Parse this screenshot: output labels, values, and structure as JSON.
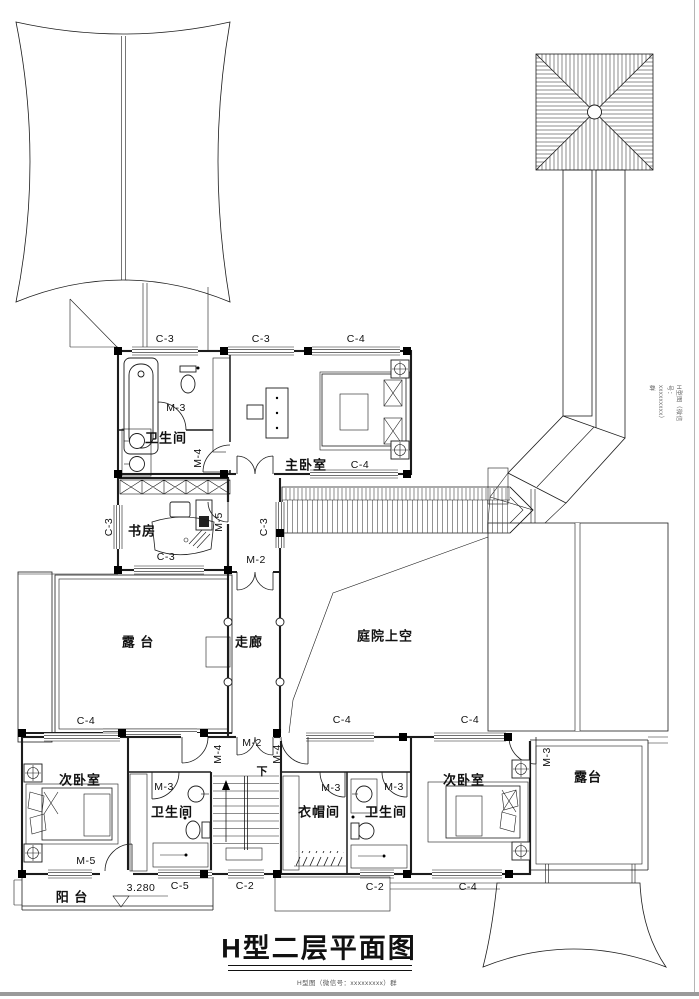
{
  "title": "H型二层平面图",
  "watermark_bottom": "H型图（微信号：xxxxxxxxx）群",
  "watermark_side": "H型图（微信号：xxxxxxxxx）群",
  "labels": [
    {
      "n": "window-tag-c3-a",
      "t": "C-3",
      "x": 165,
      "y": 339,
      "c": "code"
    },
    {
      "n": "window-tag-c3-b",
      "t": "C-3",
      "x": 261,
      "y": 339,
      "c": "code"
    },
    {
      "n": "window-tag-c4-a",
      "t": "C-4",
      "x": 356,
      "y": 339,
      "c": "code"
    },
    {
      "n": "room-label-bath-upper",
      "t": "卫生间",
      "x": 166,
      "y": 437,
      "c": "room"
    },
    {
      "n": "door-tag-m3-bath-upper",
      "t": "M-3",
      "x": 176,
      "y": 408,
      "c": "code"
    },
    {
      "n": "door-tag-m4-bath-upper",
      "t": "M-4",
      "x": 198,
      "y": 458,
      "c": "code",
      "r": 1
    },
    {
      "n": "room-label-master-bedroom",
      "t": "主卧室",
      "x": 306,
      "y": 464,
      "c": "room"
    },
    {
      "n": "window-tag-c4-master",
      "t": "C-4",
      "x": 360,
      "y": 465,
      "c": "code"
    },
    {
      "n": "room-label-study",
      "t": "书房",
      "x": 142,
      "y": 530,
      "c": "room"
    },
    {
      "n": "window-tag-c3-study-bottom",
      "t": "C-3",
      "x": 166,
      "y": 557,
      "c": "code"
    },
    {
      "n": "window-tag-c3-study-left",
      "t": "C-3",
      "x": 109,
      "y": 527,
      "c": "code",
      "r": 1
    },
    {
      "n": "door-tag-m5-study",
      "t": "M-5",
      "x": 219,
      "y": 522,
      "c": "code",
      "r": 1
    },
    {
      "n": "window-tag-c3-corridor",
      "t": "C-3",
      "x": 264,
      "y": 527,
      "c": "code",
      "r": 1
    },
    {
      "n": "door-tag-m2-corridor-top",
      "t": "M-2",
      "x": 256,
      "y": 560,
      "c": "code"
    },
    {
      "n": "room-label-terrace-left",
      "t": "露 台",
      "x": 138,
      "y": 641,
      "c": "room"
    },
    {
      "n": "window-tag-c4-terrace",
      "t": "C-4",
      "x": 86,
      "y": 721,
      "c": "code"
    },
    {
      "n": "room-label-corridor",
      "t": "走廊",
      "x": 249,
      "y": 641,
      "c": "room"
    },
    {
      "n": "room-label-courtyard",
      "t": "庭院上空",
      "x": 385,
      "y": 635,
      "c": "room"
    },
    {
      "n": "window-tag-c4-courtyard-a",
      "t": "C-4",
      "x": 342,
      "y": 720,
      "c": "code"
    },
    {
      "n": "window-tag-c4-courtyard-b",
      "t": "C-4",
      "x": 470,
      "y": 720,
      "c": "code"
    },
    {
      "n": "door-tag-m4-hall-left",
      "t": "M-4",
      "x": 218,
      "y": 754,
      "c": "code",
      "r": 1
    },
    {
      "n": "door-tag-m2-hall",
      "t": "M-2",
      "x": 252,
      "y": 743,
      "c": "code"
    },
    {
      "n": "door-tag-m4-hall-right",
      "t": "M-4",
      "x": 277,
      "y": 754,
      "c": "code",
      "r": 1
    },
    {
      "n": "stairs-down-label",
      "t": "下",
      "x": 262,
      "y": 771,
      "c": "cn-small"
    },
    {
      "n": "room-label-bedroom2-left",
      "t": "次卧室",
      "x": 80,
      "y": 779,
      "c": "room"
    },
    {
      "n": "door-tag-m5-bedroom-left",
      "t": "M-5",
      "x": 86,
      "y": 861,
      "c": "code"
    },
    {
      "n": "room-label-bath-left",
      "t": "卫生间",
      "x": 172,
      "y": 811,
      "c": "room"
    },
    {
      "n": "door-tag-m3-bath-left",
      "t": "M-3",
      "x": 164,
      "y": 787,
      "c": "code"
    },
    {
      "n": "window-tag-c5",
      "t": "C-5",
      "x": 180,
      "y": 886,
      "c": "code"
    },
    {
      "n": "window-tag-c2-stairs",
      "t": "C-2",
      "x": 245,
      "y": 886,
      "c": "code"
    },
    {
      "n": "room-label-cloakroom",
      "t": "衣帽间",
      "x": 319,
      "y": 811,
      "c": "room"
    },
    {
      "n": "door-tag-m3-cloakroom",
      "t": "M-3",
      "x": 331,
      "y": 788,
      "c": "code"
    },
    {
      "n": "room-label-bath-mid",
      "t": "卫生间",
      "x": 386,
      "y": 811,
      "c": "room"
    },
    {
      "n": "door-tag-m3-bath-mid",
      "t": "M-3",
      "x": 394,
      "y": 787,
      "c": "code"
    },
    {
      "n": "window-tag-c2-bath-mid",
      "t": "C-2",
      "x": 375,
      "y": 887,
      "c": "code"
    },
    {
      "n": "window-tag-c4-bedroom-right",
      "t": "C-4",
      "x": 468,
      "y": 887,
      "c": "code"
    },
    {
      "n": "room-label-bedroom2-right",
      "t": "次卧室",
      "x": 464,
      "y": 779,
      "c": "room"
    },
    {
      "n": "door-tag-m3-bedroom-right",
      "t": "M-3",
      "x": 547,
      "y": 757,
      "c": "code",
      "r": 1
    },
    {
      "n": "room-label-terrace-right",
      "t": "露台",
      "x": 588,
      "y": 776,
      "c": "room"
    },
    {
      "n": "room-label-balcony",
      "t": "阳 台",
      "x": 72,
      "y": 896,
      "c": "room"
    },
    {
      "n": "elevation-value",
      "t": "3.280",
      "x": 141,
      "y": 888,
      "c": "code"
    }
  ]
}
